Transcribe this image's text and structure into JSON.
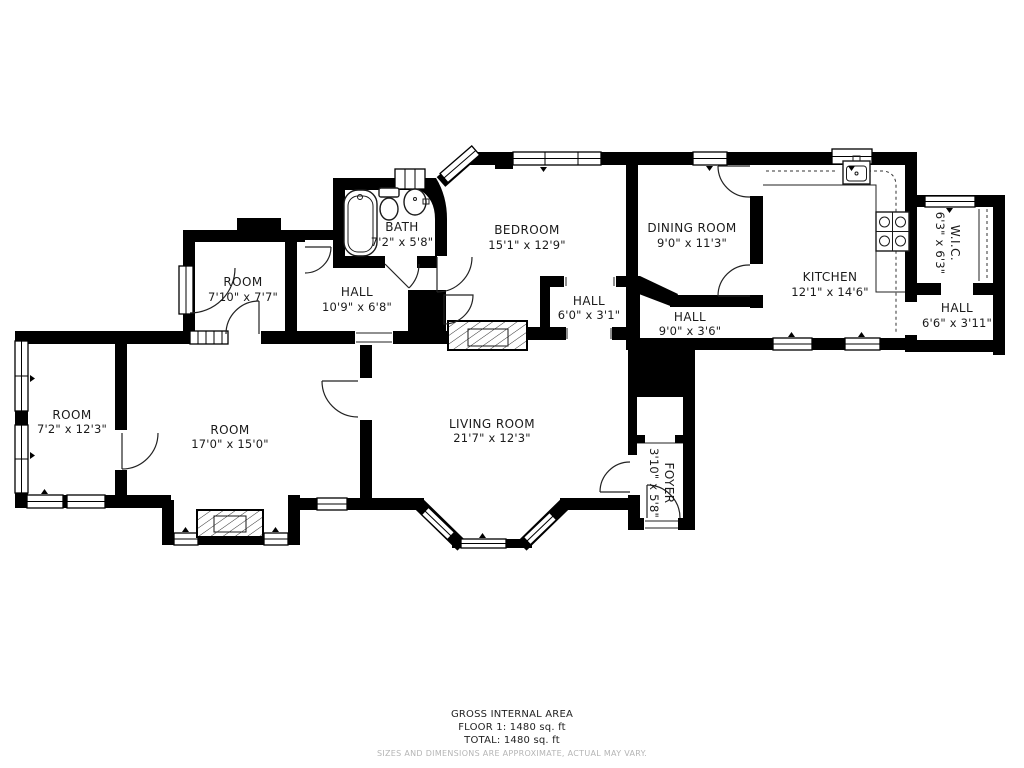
{
  "plan": {
    "rooms": [
      {
        "id": "bath",
        "name": "BATH",
        "dims": "7'2\" x 5'8\""
      },
      {
        "id": "bedroom",
        "name": "BEDROOM",
        "dims": "15'1\" x 12'9\""
      },
      {
        "id": "dining",
        "name": "DINING ROOM",
        "dims": "9'0\" x 11'3\""
      },
      {
        "id": "kitchen",
        "name": "KITCHEN",
        "dims": "12'1\" x 14'6\""
      },
      {
        "id": "wic",
        "name": "W.I.C.",
        "dims": "6'3\" x 6'3\"",
        "rotated": true
      },
      {
        "id": "hall-east",
        "name": "HALL",
        "dims": "6'6\" x 3'11\""
      },
      {
        "id": "room-upper",
        "name": "ROOM",
        "dims": "7'10\" x 7'7\""
      },
      {
        "id": "hall-west",
        "name": "HALL",
        "dims": "10'9\" x 6'8\""
      },
      {
        "id": "hall-center",
        "name": "HALL",
        "dims": "6'0\" x 3'1\""
      },
      {
        "id": "hall-mid",
        "name": "HALL",
        "dims": "9'0\" x 3'6\""
      },
      {
        "id": "room-left",
        "name": "ROOM",
        "dims": "7'2\" x 12'3\""
      },
      {
        "id": "room-big",
        "name": "ROOM",
        "dims": "17'0\" x 15'0\""
      },
      {
        "id": "living",
        "name": "LIVING ROOM",
        "dims": "21'7\" x 12'3\""
      },
      {
        "id": "foyer",
        "name": "FOYER",
        "dims": "3'10\" x 5'8\"",
        "rotated": true
      }
    ],
    "footer": {
      "area_title": "GROSS INTERNAL AREA",
      "floor_line": "FLOOR 1: 1480 sq. ft",
      "total_line": "TOTAL: 1480 sq. ft",
      "disclaimer": "SIZES AND DIMENSIONS ARE APPROXIMATE, ACTUAL MAY VARY."
    },
    "colors": {
      "wall": "#000000",
      "label_text": "#1a1a1a",
      "disclaimer_text": "#b5b5b5",
      "background": "#ffffff"
    }
  }
}
